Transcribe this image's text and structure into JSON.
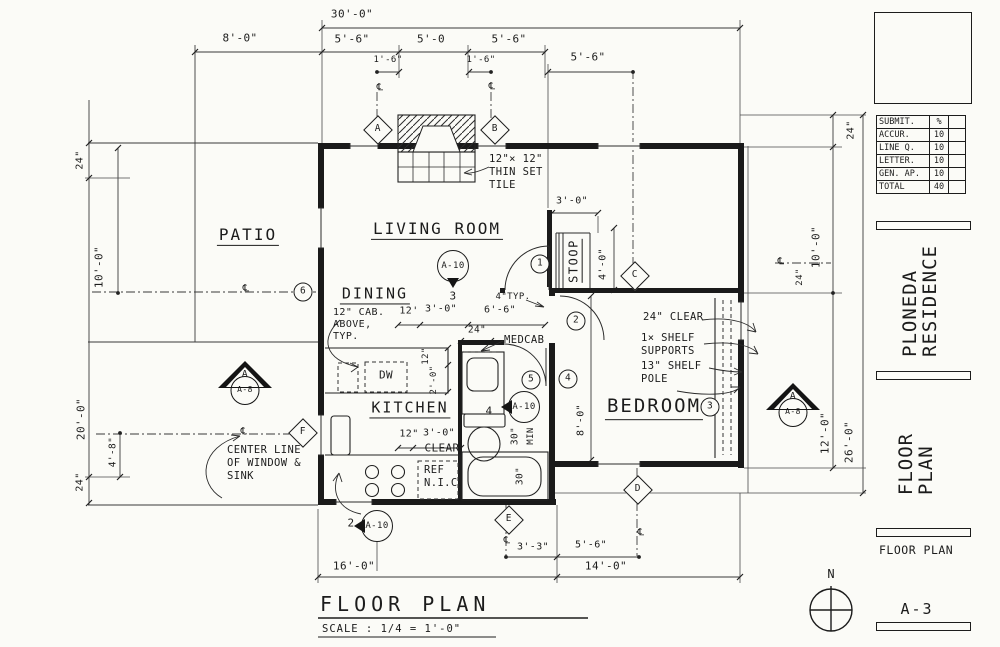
{
  "sheet": {
    "titleblock": {
      "grade_rows": [
        [
          "SUBMIT.",
          "%"
        ],
        [
          "ACCUR.",
          "10"
        ],
        [
          "LINE Q.",
          "10"
        ],
        [
          "LETTER.",
          "10"
        ],
        [
          "GEN. AP.",
          "10"
        ],
        [
          "TOTAL",
          "40"
        ]
      ],
      "project_name": "PLONEDA\nRESIDENCE",
      "sheet_title": "FLOOR\nPLAN",
      "sheet_label": "FLOOR PLAN",
      "sheet_number": "A-3"
    },
    "drawing_title": {
      "title": "FLOOR PLAN",
      "scale": "SCALE : 1/4 = 1'-0\""
    },
    "north_label": "N"
  },
  "plan": {
    "annotations": [
      {
        "n": "dim-overall-30",
        "t": "dim",
        "tx": "30'-0\"",
        "x": 352,
        "y": 15,
        "fs": 11
      },
      {
        "n": "dim-patio-8",
        "t": "dim",
        "tx": "8'-0\"",
        "x": 240,
        "y": 39,
        "fs": 11
      },
      {
        "n": "dim-win-5-6-a",
        "t": "dim",
        "tx": "5'-6\"",
        "x": 352,
        "y": 40,
        "fs": 11
      },
      {
        "n": "dim-win-5-0",
        "t": "dim",
        "tx": "5'-0",
        "x": 431,
        "y": 40,
        "fs": 11
      },
      {
        "n": "dim-win-5-6-b",
        "t": "dim",
        "tx": "5'-6\"",
        "x": 509,
        "y": 40,
        "fs": 11
      },
      {
        "n": "dim-1-6-a",
        "t": "dim",
        "tx": "1'-6\"",
        "x": 388,
        "y": 60,
        "fs": 9
      },
      {
        "n": "dim-1-6-b",
        "t": "dim",
        "tx": "1'-6\"",
        "x": 481,
        "y": 60,
        "fs": 9
      },
      {
        "n": "dim-5-6-c",
        "t": "dim",
        "tx": "5'-6\"",
        "x": 588,
        "y": 58,
        "fs": 11
      },
      {
        "n": "dim-stoop-3-0",
        "t": "dim",
        "tx": "3'-0\"",
        "x": 572,
        "y": 201,
        "fs": 10
      },
      {
        "n": "note-4-typ",
        "t": "dim",
        "tx": "4\"TYP.",
        "x": 513,
        "y": 297,
        "fs": 9
      },
      {
        "n": "dim-dining-12",
        "t": "dim",
        "tx": "12'",
        "x": 409,
        "y": 311,
        "fs": 10
      },
      {
        "n": "dim-dining-3-0",
        "t": "dim",
        "tx": "3'-0\"",
        "x": 441,
        "y": 309,
        "fs": 10
      },
      {
        "n": "dim-6-6",
        "t": "dim",
        "tx": "6'-6\"",
        "x": 500,
        "y": 310,
        "fs": 10
      },
      {
        "n": "dim-medcab-24",
        "t": "dim",
        "tx": "24\"",
        "x": 477,
        "y": 331,
        "fs": 9.5
      },
      {
        "n": "dim-kitchen-12",
        "t": "dim",
        "tx": "12\"",
        "x": 409,
        "y": 434,
        "fs": 10
      },
      {
        "n": "dim-kitchen-3-0",
        "t": "dim",
        "tx": "3'-0\"",
        "x": 439,
        "y": 433,
        "fs": 10
      },
      {
        "n": "label-clear",
        "t": "dim",
        "tx": "CLEAR",
        "x": 442,
        "y": 449,
        "fs": 11
      },
      {
        "n": "label-dw",
        "t": "dim",
        "tx": "DW",
        "x": 386,
        "y": 376,
        "fs": 11
      },
      {
        "n": "dim-bottom-16",
        "t": "dim",
        "tx": "16'-0\"",
        "x": 354,
        "y": 567,
        "fs": 11
      },
      {
        "n": "dim-bottom-14",
        "t": "dim",
        "tx": "14'-0\"",
        "x": 606,
        "y": 567,
        "fs": 11
      },
      {
        "n": "dim-bottom-3-3",
        "t": "dim",
        "tx": "3'-3\"",
        "x": 533,
        "y": 547,
        "fs": 10
      },
      {
        "n": "dim-bottom-5-6",
        "t": "dim",
        "tx": "5'-6\"",
        "x": 591,
        "y": 545,
        "fs": 10
      },
      {
        "n": "centerline-sym-1",
        "t": "dim",
        "tx": "℄",
        "x": 380,
        "y": 88,
        "fs": 10
      },
      {
        "n": "centerline-sym-2",
        "t": "dim",
        "tx": "℄",
        "x": 492,
        "y": 87,
        "fs": 10
      },
      {
        "n": "centerline-sym-3",
        "t": "dim",
        "tx": "℄",
        "x": 246,
        "y": 289,
        "fs": 10
      },
      {
        "n": "centerline-sym-4",
        "t": "dim",
        "tx": "℄",
        "x": 244,
        "y": 432,
        "fs": 10
      },
      {
        "n": "centerline-sym-5",
        "t": "dim",
        "tx": "℄",
        "x": 781,
        "y": 262,
        "fs": 10
      },
      {
        "n": "centerline-sym-6",
        "t": "dim",
        "tx": "℄",
        "x": 507,
        "y": 541,
        "fs": 10
      },
      {
        "n": "centerline-sym-7",
        "t": "dim",
        "tx": "℄",
        "x": 641,
        "y": 533,
        "fs": 10
      },
      {
        "n": "detail-num-3",
        "t": "dim",
        "tx": "3",
        "x": 453,
        "y": 297,
        "fs": 11
      },
      {
        "n": "detail-num-4",
        "t": "dim",
        "tx": "4",
        "x": 489,
        "y": 412,
        "fs": 11
      },
      {
        "n": "detail-num-2",
        "t": "dim",
        "tx": "2",
        "x": 351,
        "y": 524,
        "fs": 11
      },
      {
        "n": "dim-left-24-top",
        "t": "dimv",
        "tx": "24\"",
        "x": 80,
        "y": 160,
        "fs": 10
      },
      {
        "n": "dim-left-10-0",
        "t": "dimv",
        "tx": "10'-0\"",
        "x": 100,
        "y": 267,
        "fs": 11
      },
      {
        "n": "dim-left-20-0",
        "t": "dimv",
        "tx": "20'-0\"",
        "x": 82,
        "y": 419,
        "fs": 11
      },
      {
        "n": "dim-left-4-8",
        "t": "dimv",
        "tx": "4'-8\"",
        "x": 114,
        "y": 452,
        "fs": 9.5
      },
      {
        "n": "dim-left-24-bot",
        "t": "dimv",
        "tx": "24\"",
        "x": 80,
        "y": 482,
        "fs": 10
      },
      {
        "n": "dim-right-24-top",
        "t": "dimv",
        "tx": "24\"",
        "x": 851,
        "y": 130,
        "fs": 10
      },
      {
        "n": "dim-right-10-0",
        "t": "dimv",
        "tx": "10'-0\"",
        "x": 817,
        "y": 247,
        "fs": 11
      },
      {
        "n": "dim-right-24-mid",
        "t": "dimv",
        "tx": "24\"",
        "x": 800,
        "y": 277,
        "fs": 9
      },
      {
        "n": "dim-right-12-0",
        "t": "dimv",
        "tx": "12'-0\"",
        "x": 826,
        "y": 433,
        "fs": 11
      },
      {
        "n": "dim-right-26-0",
        "t": "dimv",
        "tx": "26'-0\"",
        "x": 850,
        "y": 442,
        "fs": 11
      },
      {
        "n": "dim-stoop-4-0",
        "t": "dimv",
        "tx": "4'-0\"",
        "x": 603,
        "y": 264,
        "fs": 10
      },
      {
        "n": "dim-bedroom-8-0",
        "t": "dimv",
        "tx": "8'-0\"",
        "x": 581,
        "y": 420,
        "fs": 10
      },
      {
        "n": "dim-dw-12",
        "t": "dimv",
        "tx": "12\"",
        "x": 426,
        "y": 356,
        "fs": 9
      },
      {
        "n": "dim-dw-2-0",
        "t": "dimv",
        "tx": "2'-0\"",
        "x": 434,
        "y": 380,
        "fs": 9
      },
      {
        "n": "dim-sink-30",
        "t": "dimv",
        "tx": "30\"",
        "x": 516,
        "y": 436,
        "fs": 9.5
      },
      {
        "n": "label-min",
        "t": "dimv",
        "tx": "MIN",
        "x": 531,
        "y": 436,
        "fs": 9
      },
      {
        "n": "dim-tub-30",
        "t": "dimv",
        "tx": "30\"",
        "x": 521,
        "y": 476,
        "fs": 9.5
      },
      {
        "n": "room-patio",
        "t": "room",
        "tx": "PATIO",
        "x": 248,
        "y": 236,
        "fs": 16
      },
      {
        "n": "room-living",
        "t": "room",
        "tx": "LIVING ROOM",
        "x": 437,
        "y": 230,
        "fs": 16
      },
      {
        "n": "room-dining",
        "t": "room",
        "tx": "DINING",
        "x": 375,
        "y": 295,
        "fs": 15
      },
      {
        "n": "room-kitchen",
        "t": "room",
        "tx": "KITCHEN",
        "x": 410,
        "y": 409,
        "fs": 15
      },
      {
        "n": "room-bedroom",
        "t": "room",
        "tx": "BEDROOM",
        "x": 654,
        "y": 408,
        "fs": 19
      },
      {
        "n": "room-stoop",
        "t": "roomv",
        "tx": "STOOP",
        "x": 575,
        "y": 261,
        "fs": 12
      },
      {
        "n": "note-tile",
        "t": "note",
        "tx": "12\"× 12\"\nTHIN SET\nTILE",
        "x": 489,
        "y": 153,
        "fs": 10.5
      },
      {
        "n": "note-cab-above",
        "t": "note",
        "tx": "12\" CAB.\nABOVE,\nTYP.",
        "x": 333,
        "y": 307,
        "fs": 10
      },
      {
        "n": "note-medcab",
        "t": "note",
        "tx": "MEDCAB",
        "x": 504,
        "y": 334,
        "fs": 10.5
      },
      {
        "n": "note-ref-nic",
        "t": "note",
        "tx": "REF\nN.I.C.",
        "x": 424,
        "y": 464,
        "fs": 10.5
      },
      {
        "n": "note-center-line",
        "t": "note",
        "tx": "CENTER LINE\nOF WINDOW &\nSINK",
        "x": 227,
        "y": 444,
        "fs": 10.5
      },
      {
        "n": "note-24-clear",
        "t": "note",
        "tx": "24\" CLEAR",
        "x": 643,
        "y": 311,
        "fs": 10.5
      },
      {
        "n": "note-shelf-supports",
        "t": "note",
        "tx": "1× SHELF\nSUPPORTS",
        "x": 641,
        "y": 332,
        "fs": 10.5
      },
      {
        "n": "note-shelf-pole",
        "t": "note",
        "tx": "13\" SHELF\nPOLE",
        "x": 641,
        "y": 360,
        "fs": 10.5
      },
      {
        "n": "keynote-1",
        "t": "cmark",
        "tx": "1",
        "x": 540,
        "y": 264
      },
      {
        "n": "keynote-2",
        "t": "cmark",
        "tx": "2",
        "x": 576,
        "y": 321
      },
      {
        "n": "keynote-3",
        "t": "cmark",
        "tx": "3",
        "x": 710,
        "y": 407
      },
      {
        "n": "keynote-4",
        "t": "cmark",
        "tx": "4",
        "x": 568,
        "y": 379
      },
      {
        "n": "keynote-5",
        "t": "cmark",
        "tx": "5",
        "x": 531,
        "y": 380
      },
      {
        "n": "keynote-6",
        "t": "cmark",
        "tx": "6",
        "x": 303,
        "y": 292
      },
      {
        "n": "grid-marker-a",
        "t": "dmark",
        "tx": "A",
        "x": 378,
        "y": 130
      },
      {
        "n": "grid-marker-b",
        "t": "dmark",
        "tx": "B",
        "x": 495,
        "y": 130
      },
      {
        "n": "grid-marker-c",
        "t": "dmark",
        "tx": "C",
        "x": 635,
        "y": 276
      },
      {
        "n": "grid-marker-d",
        "t": "dmark",
        "tx": "D",
        "x": 638,
        "y": 490
      },
      {
        "n": "grid-marker-e",
        "t": "dmark",
        "tx": "E",
        "x": 509,
        "y": 520
      },
      {
        "n": "grid-marker-f",
        "t": "dmark",
        "tx": "F",
        "x": 303,
        "y": 433
      },
      {
        "n": "detail-balloon-living",
        "t": "balloon",
        "tx": "A-10",
        "x": 453,
        "y": 266,
        "dir": "down"
      },
      {
        "n": "detail-balloon-bath",
        "t": "balloon",
        "tx": "A-10",
        "x": 524,
        "y": 407,
        "dir": "left"
      },
      {
        "n": "detail-balloon-kitchen",
        "t": "balloon",
        "tx": "A-10",
        "x": 377,
        "y": 526,
        "dir": "left"
      },
      {
        "n": "section-marker-left",
        "t": "smark",
        "tx": "A",
        "ref": "A-8",
        "x": 245,
        "y": 384
      },
      {
        "n": "section-marker-right",
        "t": "smark",
        "tx": "A",
        "ref": "A-8",
        "x": 793,
        "y": 406
      }
    ]
  }
}
